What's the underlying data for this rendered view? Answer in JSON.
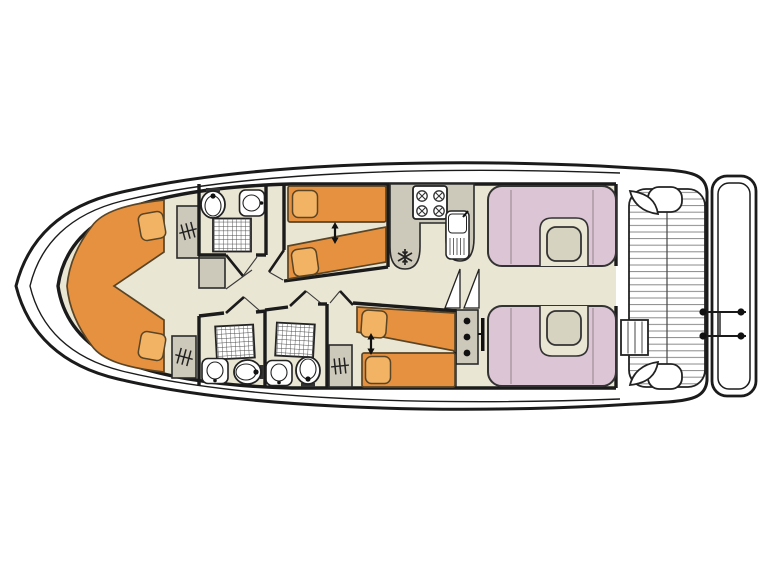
{
  "colors": {
    "outline": "#1b1b1b",
    "floor": "#eae6d4",
    "bed": "#e6913f",
    "pillow": "#f2b464",
    "cabinet": "#ccc9ba",
    "seat_pink": "#dcc5d4",
    "table": "#d6d3c1",
    "fixture_white": "#ffffff",
    "deck_line": "#888888"
  },
  "plan": {
    "type": "boat-floor-plan",
    "orientation": "bow-left-stern-right",
    "areas": [
      {
        "id": "bow-cabin",
        "fixtures": [
          "v-berth-double-bed",
          "pillow",
          "pillow",
          "wardrobe",
          "wardrobe",
          "cabinet"
        ]
      },
      {
        "id": "bathroom-forward",
        "fixtures": [
          "toilet",
          "washbasin",
          "shower"
        ]
      },
      {
        "id": "cabin-midship",
        "fixtures": [
          "single-bed",
          "single-bed",
          "slide-together-arrow"
        ]
      },
      {
        "id": "galley",
        "fixtures": [
          "stove-4-burners",
          "sink-with-drainer",
          "refrigerator-snowflake"
        ]
      },
      {
        "id": "companionway",
        "fixtures": [
          "stairs-wedges",
          "step-block-3-dots"
        ]
      },
      {
        "id": "saloon",
        "fixtures": [
          "u-dinette-with-table",
          "u-dinette-with-table"
        ]
      },
      {
        "id": "bathroom-aft-1",
        "fixtures": [
          "shower",
          "washbasin",
          "toilet"
        ]
      },
      {
        "id": "bathroom-aft-2",
        "fixtures": [
          "shower",
          "washbasin",
          "toilet"
        ]
      },
      {
        "id": "wardrobe-aft",
        "fixtures": [
          "wardrobe"
        ]
      },
      {
        "id": "cabin-aft",
        "fixtures": [
          "single-bed",
          "single-bed",
          "slide-together-arrow"
        ]
      },
      {
        "id": "aft-deck",
        "fixtures": [
          "slatted-floor",
          "corner-seat",
          "corner-seat",
          "deck-steps",
          "stern-rail-ladder",
          "swim-platform"
        ]
      }
    ]
  }
}
